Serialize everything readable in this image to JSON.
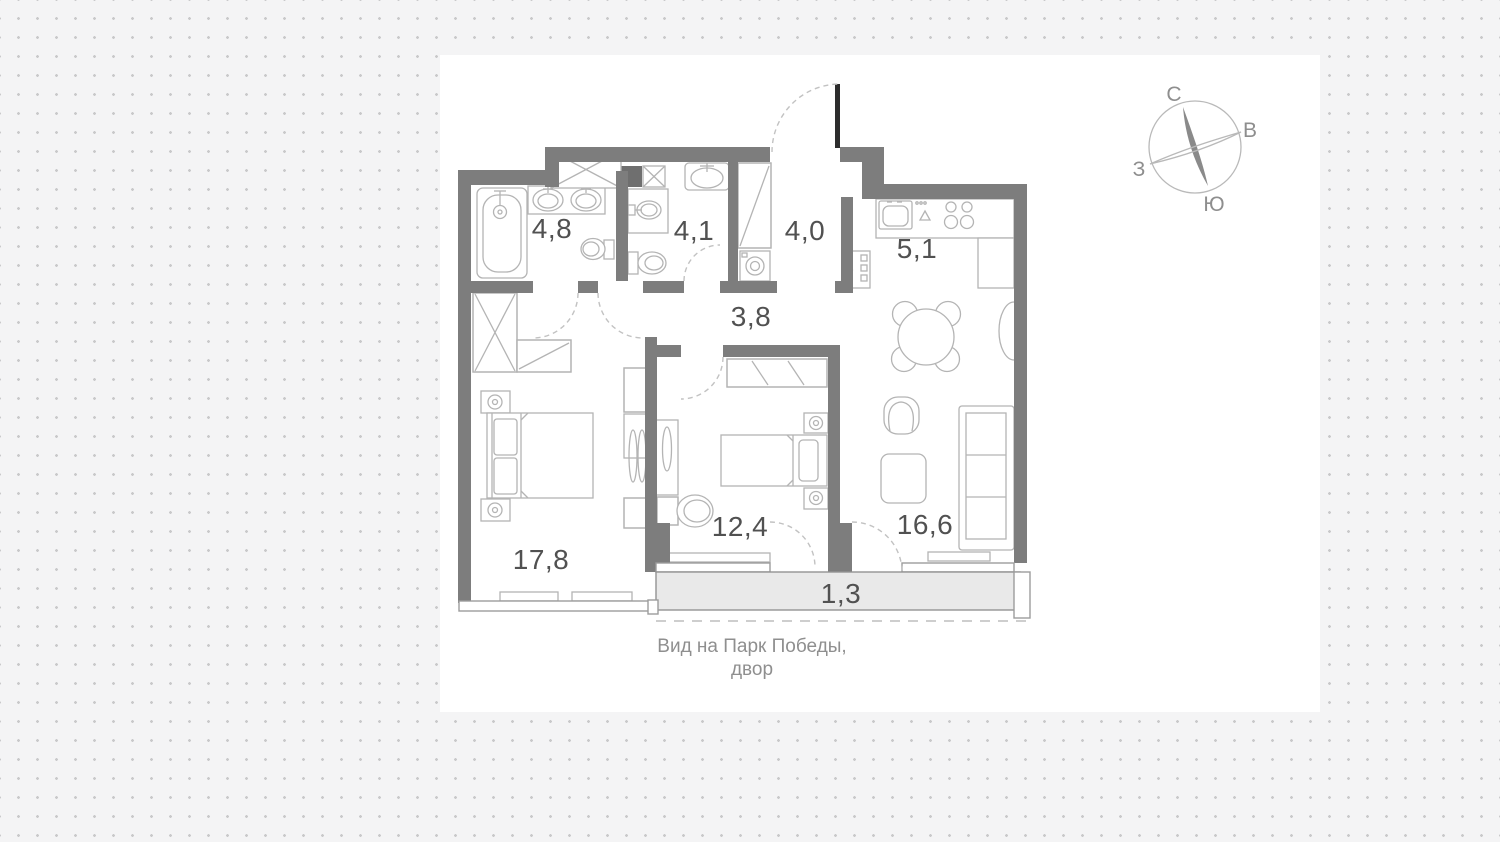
{
  "plan": {
    "rooms": [
      {
        "name": "bathroom",
        "area": "4,8"
      },
      {
        "name": "wc",
        "area": "4,1"
      },
      {
        "name": "hallway",
        "area": "4,0"
      },
      {
        "name": "kitchen",
        "area": "5,1"
      },
      {
        "name": "corridor",
        "area": "3,8"
      },
      {
        "name": "bedroom",
        "area": "17,8"
      },
      {
        "name": "bedroom-2",
        "area": "12,4"
      },
      {
        "name": "living-room",
        "area": "16,6"
      },
      {
        "name": "balcony",
        "area": "1,3"
      }
    ],
    "caption_line1": "Вид на Парк Победы,",
    "caption_line2": "двор"
  },
  "compass": {
    "north": "С",
    "east": "В",
    "west": "З",
    "south": "Ю"
  },
  "colors": {
    "background": "#f4f4f5",
    "dot": "#c9c9ca",
    "panel": "#ffffff",
    "wall": "#7d7d7d",
    "door_leaf": "#2d2d2d",
    "furniture": "#b4b4b4",
    "balcony_fill": "#e9e9e9",
    "room_label": "#515151",
    "caption": "#8f8f8f",
    "compass": "#8e8e8e"
  }
}
